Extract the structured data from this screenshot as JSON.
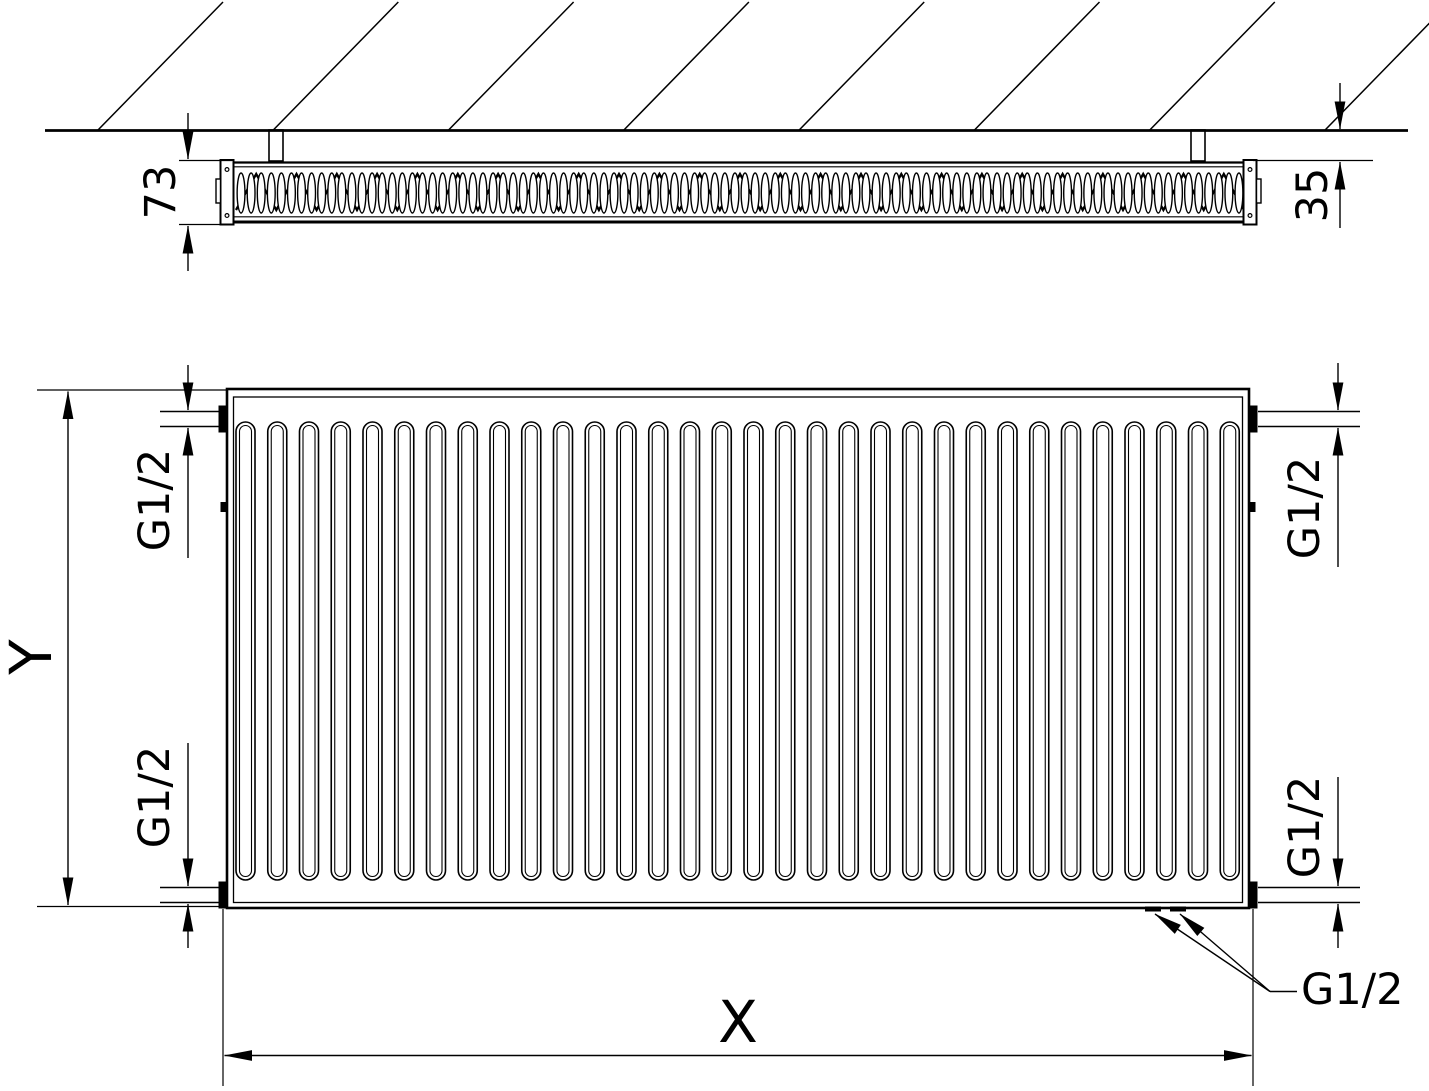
{
  "drawing": {
    "title": "panel radiator dimensional drawing",
    "type": "technical-drawing",
    "top_view": {
      "depth_dim": "73",
      "wall_gap_dim": "35"
    },
    "front_view": {
      "width_dim": "X",
      "height_dim": "Y",
      "conn_top_left": "G1/2",
      "conn_bottom_left": "G1/2",
      "conn_top_right": "G1/2",
      "conn_bottom_right": "G1/2",
      "conn_bottom_leader": "G1/2"
    },
    "colors": {
      "line": "#000000",
      "background": "#ffffff"
    },
    "counts": {
      "front_channels": 32,
      "top_fin_loops": 100,
      "hatch_lines": 8
    }
  }
}
